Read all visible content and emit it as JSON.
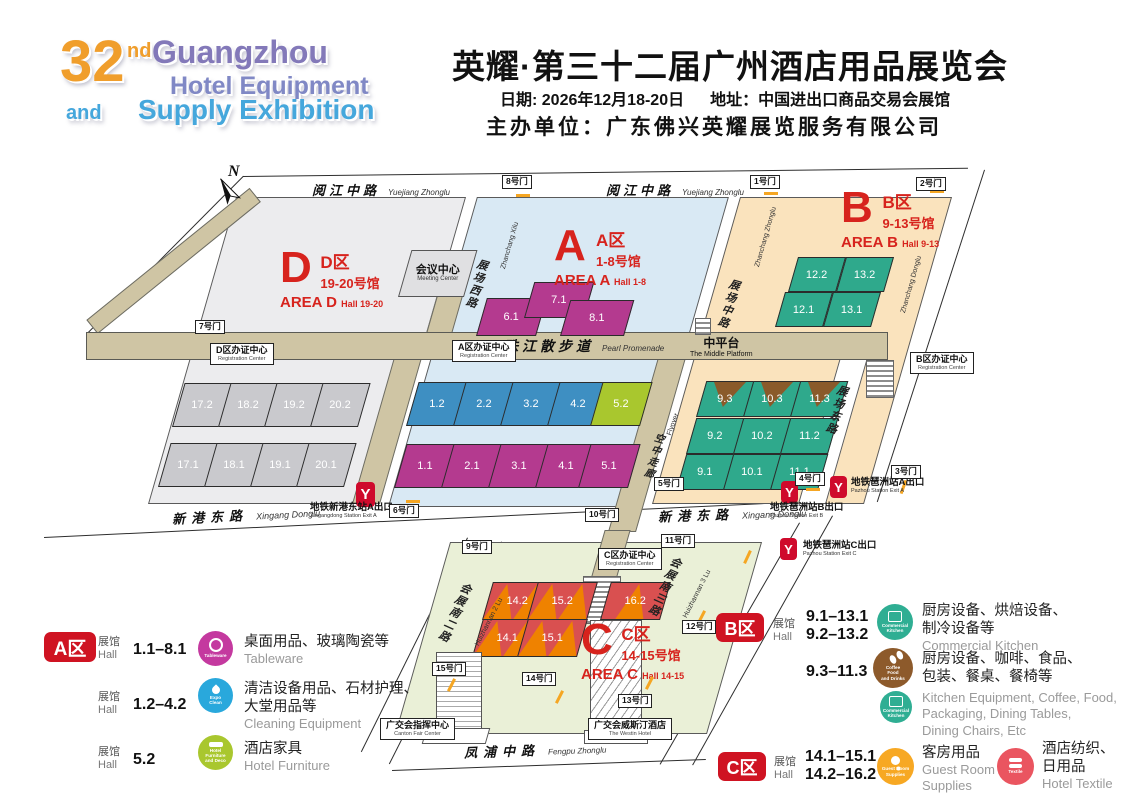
{
  "colors": {
    "red": "#d7231d",
    "magenta": "#b43a8f",
    "blue": "#3e8fc2",
    "lime": "#a9c72e",
    "teal": "#2fa98c",
    "brown": "#8a5a2a",
    "gray_hall": "#c9c9cd",
    "c_red": "#d95050",
    "c_orange": "#ef8200",
    "zone_d": "#ececee",
    "zone_a": "#d9e9f4",
    "zone_b": "#fae3bd",
    "zone_c": "#eaf0d7",
    "tan": "#cfc5a4",
    "badge_red": "#cf1322",
    "metro_red": "#cf0a2c",
    "icon_tableware": "#c4399f",
    "icon_clean": "#29a8dc",
    "icon_furniture": "#a9c72e",
    "icon_kitchen": "#2fae93",
    "icon_coffee": "#8d5a2b",
    "icon_guest": "#f7a823",
    "icon_textile": "#ea5560",
    "logo_orange": "#f09e2c",
    "logo_purple": "#8379b9",
    "logo_purple2": "#8088c5",
    "logo_blue": "#45a7dc"
  },
  "header": {
    "logo_num": "32",
    "logo_sup": "nd",
    "logo_l1": "Guangzhou",
    "logo_l2": "Hotel Equipment",
    "logo_and": "and",
    "logo_l3": "Supply Exhibition",
    "title": "英耀·第三十二届广州酒店用品展览会",
    "date": "日期: 2026年12月18-20日",
    "address": "地址：中国进出口商品交易会展馆",
    "organizer": "主办单位：广东佛兴英耀展览服务有限公司"
  },
  "map": {
    "compass": "N",
    "roads": {
      "yuejiang": "阅江中路",
      "yuejiang_py": "Yuejiang Zhonglu",
      "xingang": "新港东路",
      "xingang_py": "Xingang Donglu",
      "fengpu": "凤浦中路",
      "fengpu_py": "Fengpu Zhonglu",
      "zhanchang_xi": "展场西路",
      "zhanchang_xi_py": "Zhanchang Xilu",
      "zhanchang_zhong": "展场中路",
      "zhanchang_zhong_py": "Zhanchang Zhonglu",
      "zhanchang_dong": "展场东路",
      "zhanchang_dong_py": "Zhanchang Donglu",
      "huizhan2": "会展南二路",
      "huizhan2_py": "Huizhannan 2 Lu",
      "huizhan3": "会展南三路",
      "huizhan3_py": "Huizhannan 3 Lu",
      "promenade": "珠江散步道",
      "promenade_py": "Pearl Promenade",
      "platform": "中平台",
      "platform_py": "The Middle Platform",
      "flyover": "空中走廊",
      "flyover_py": "Flyover"
    },
    "gates": {
      "g1": "1号门",
      "g2": "2号门",
      "g3": "3号门",
      "g4": "4号门",
      "g5": "5号门",
      "g6": "6号门",
      "g7": "7号门",
      "g8": "8号门",
      "g9": "9号门",
      "g10": "10号门",
      "g11": "11号门",
      "g12": "12号门",
      "g13": "13号门",
      "g14": "14号门",
      "g15": "15号门"
    },
    "areas": {
      "d": {
        "letter": "D",
        "zone": "D区",
        "range": "19-20号馆",
        "en": "AREA D",
        "hall_en": "Hall 19-20"
      },
      "a": {
        "letter": "A",
        "zone": "A区",
        "range": "1-8号馆",
        "en": "AREA A",
        "hall_en": "Hall 1-8"
      },
      "b": {
        "letter": "B",
        "zone": "B区",
        "range": "9-13号馆",
        "en": "AREA B",
        "hall_en": "Hall 9-13"
      },
      "c": {
        "letter": "C",
        "zone": "C区",
        "range": "14-15号馆",
        "en": "AREA C",
        "hall_en": "Hall 14-15"
      }
    },
    "halls": {
      "d": [
        "17.2",
        "18.2",
        "19.2",
        "20.2",
        "17.1",
        "18.1",
        "19.1",
        "20.1"
      ],
      "a_top": [
        "6.1",
        "7.1",
        "8.1"
      ],
      "a_blue": [
        "1.2",
        "2.2",
        "3.2",
        "4.2"
      ],
      "a_lime": "5.2",
      "a_magenta": [
        "1.1",
        "2.1",
        "3.1",
        "4.1",
        "5.1"
      ],
      "b_upper": [
        "12.2",
        "13.2",
        "12.1",
        "13.1"
      ],
      "b_lower": [
        "9.3",
        "10.3",
        "11.3",
        "9.2",
        "10.2",
        "11.2",
        "9.1",
        "10.1",
        "11.1"
      ],
      "c": [
        "14.2",
        "15.2",
        "16.2",
        "14.1",
        "15.1"
      ]
    },
    "labels": {
      "meeting": "会议中心",
      "meeting_en": "Meeting Center",
      "reg_d": "D区办证中心",
      "reg_a": "A区办证中心",
      "reg_b": "B区办证中心",
      "reg_c": "C区办证中心",
      "reg_en": "Registration Center",
      "canton": "广交会指挥中心",
      "canton_en": "Canton Fair Center",
      "westin": "广交会威斯汀酒店",
      "westin_en": "The Westin Hotel"
    },
    "metro": {
      "xingangdong_a": "地铁新港东站A出口",
      "xingangdong_a_en": "Xingangdong Station Exit A",
      "pazhou_a": "地铁琶洲站A出口",
      "pazhou_a_en": "Pazhou Station Exit A",
      "pazhou_b": "地铁琶洲站B出口",
      "pazhou_b_en": "Pazhou Station Exit B",
      "pazhou_c": "地铁琶洲站C出口",
      "pazhou_c_en": "Pazhou Station Exit C"
    }
  },
  "legend": {
    "hall_zh": "展馆",
    "hall_en": "Hall",
    "a": {
      "badge": "A区",
      "rows": [
        {
          "range": "1.1–8.1",
          "icon": "Tableware",
          "zh": "桌面用品、玻璃陶瓷等",
          "zh2": "",
          "en": "Tableware"
        },
        {
          "range": "1.2–4.2",
          "icon": "Expo\nClean",
          "zh": "清洁设备用品、石材护理、",
          "zh2": "大堂用品等",
          "en": "Cleaning Equipment"
        },
        {
          "range": "5.2",
          "icon": "Hotel\nFurniture\nand Deco",
          "zh": "酒店家具",
          "zh2": "",
          "en": "Hotel Furniture"
        }
      ]
    },
    "b": {
      "badge": "B区",
      "range1a": "9.1–13.1",
      "range1b": "9.2–13.2",
      "icon1": "Commercial\nKitchen",
      "zh1": "厨房设备、烘焙设备、",
      "zh1b": "制冷设备等",
      "en1": "Commercial Kitchen",
      "range2": "9.3–11.3",
      "icon2": "Coffee\nFood\nand Drinks",
      "zh2": "厨房设备、咖啡、食品、",
      "zh2b": "包装、餐桌、餐椅等",
      "icon3": "Commercial\nKitchen",
      "en3a": "Kitchen Equipment, Coffee, Food,",
      "en3b": "Packaging, Dining Tables,",
      "en3c": "Dining Chairs, Etc"
    },
    "c": {
      "badge": "C区",
      "range1": "14.1–15.1",
      "range2": "14.2–16.2",
      "icon1": "Guest Room\nSupplies",
      "zh1": "客房用品",
      "en1a": "Guest Room",
      "en1b": "Supplies",
      "icon2": "Textile",
      "zh2a": "酒店纺织、",
      "zh2b": "日用品",
      "en2": "Hotel Textile"
    }
  }
}
